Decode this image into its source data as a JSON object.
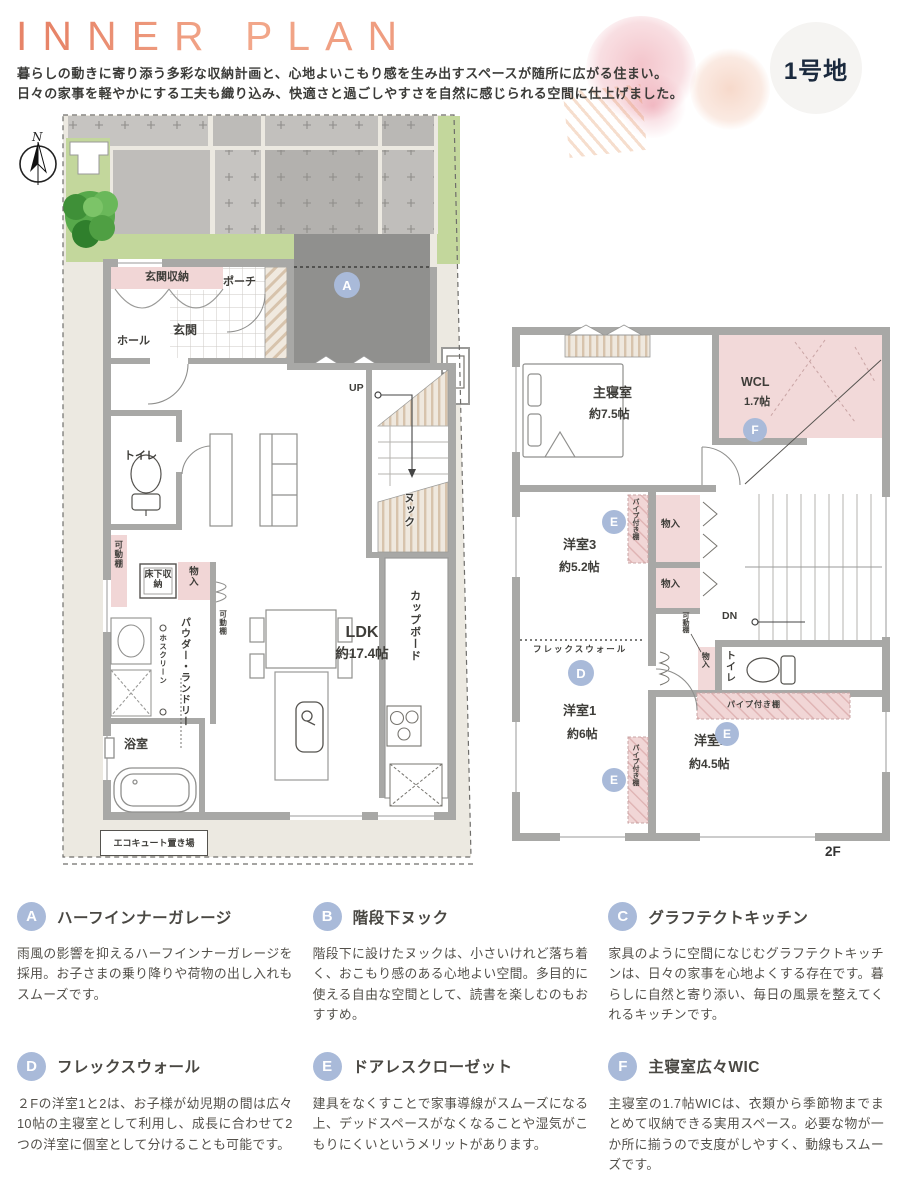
{
  "header": {
    "title": "INNER PLAN",
    "description_line1": "暮らしの動きに寄り添う多彩な収納計画と、心地よいこもり感を生み出すスペースが随所に広がる住まい。",
    "description_line2": "日々の家事を軽やかにする工夫も織り込み、快適さと過ごしやすさを自然に感じられる空間に仕上げました。",
    "lot_badge": "1号地",
    "compass_north": "N"
  },
  "floorplan_1f": {
    "badge_a": "A",
    "labels": {
      "genkan_shuno": "玄関収納",
      "porch": "ポーチ",
      "genkan": "玄関",
      "hall": "ホール",
      "toilet": "トイレ",
      "kadodana": "可動棚",
      "yukashita_shuno": "床下収納",
      "monoire": "物入",
      "powder_laundry": "パウダー・ランドリー",
      "hoscreen": "ホスクリーン",
      "bathroom": "浴室",
      "ldk_name": "LDK",
      "ldk_size": "約17.4帖",
      "up": "UP",
      "nook": "ヌック",
      "cupboard": "カップボード",
      "ecocute": "エコキュート置き場"
    }
  },
  "floorplan_2f": {
    "badges": {
      "d": "D",
      "e": "E",
      "f": "F"
    },
    "floor_tag": "2F",
    "labels": {
      "master_name": "主寝室",
      "master_size": "約7.5帖",
      "wcl_name": "WCL",
      "wcl_size": "1.7帖",
      "pipe_shelf": "パイプ付き棚",
      "monoire": "物入",
      "yoshitsu3_name": "洋室3",
      "yoshitsu3_size": "約5.2帖",
      "flex_wall": "フレックスウォール",
      "yoshitsu1_name": "洋室1",
      "yoshitsu1_size": "約6帖",
      "yoshitsu2_name": "洋室2",
      "yoshitsu2_size": "約4.5帖",
      "kadodana": "可動棚",
      "toilet": "トイレ",
      "dn": "DN"
    }
  },
  "features": [
    {
      "badge": "A",
      "title": "ハーフインナーガレージ",
      "body": "雨風の影響を抑えるハーフインナーガレージを採用。お子さまの乗り降りや荷物の出し入れもスムーズです。"
    },
    {
      "badge": "B",
      "title": "階段下ヌック",
      "body": "階段下に設けたヌックは、小さいけれど落ち着く、おこもり感のある心地よい空間。多目的に使える自由な空間として、読書を楽しむのもおすすめ。"
    },
    {
      "badge": "C",
      "title": "グラフテクトキッチン",
      "body": "家具のように空間になじむグラフテクトキッチンは、日々の家事を心地よくする存在です。暮らしに自然と寄り添い、毎日の風景を整えてくれるキッチンです。"
    },
    {
      "badge": "D",
      "title": "フレックスウォール",
      "body": "２Fの洋室1と2は、お子様が幼児期の間は広々10帖の主寝室として利用し、成長に合わせて2つの洋室に個室として分けることも可能です。"
    },
    {
      "badge": "E",
      "title": "ドアレスクローゼット",
      "body": "建具をなくすことで家事導線がスムーズになる上、デッドスペースがなくなることや湿気がこもりにくいというメリットがあります。"
    },
    {
      "badge": "F",
      "title": "主寝室広々WIC",
      "body": "主寝室の1.7帖WICは、衣類から季節物までまとめて収納できる実用スペース。必要な物が一か所に揃うので支度がしやすく、動線もスムーズです。"
    }
  ],
  "colors": {
    "accent": "#EC8E6F",
    "badge": "#A9BAD9",
    "pink_zone": "#F1D6D6",
    "wall": "#A8A8A6"
  }
}
